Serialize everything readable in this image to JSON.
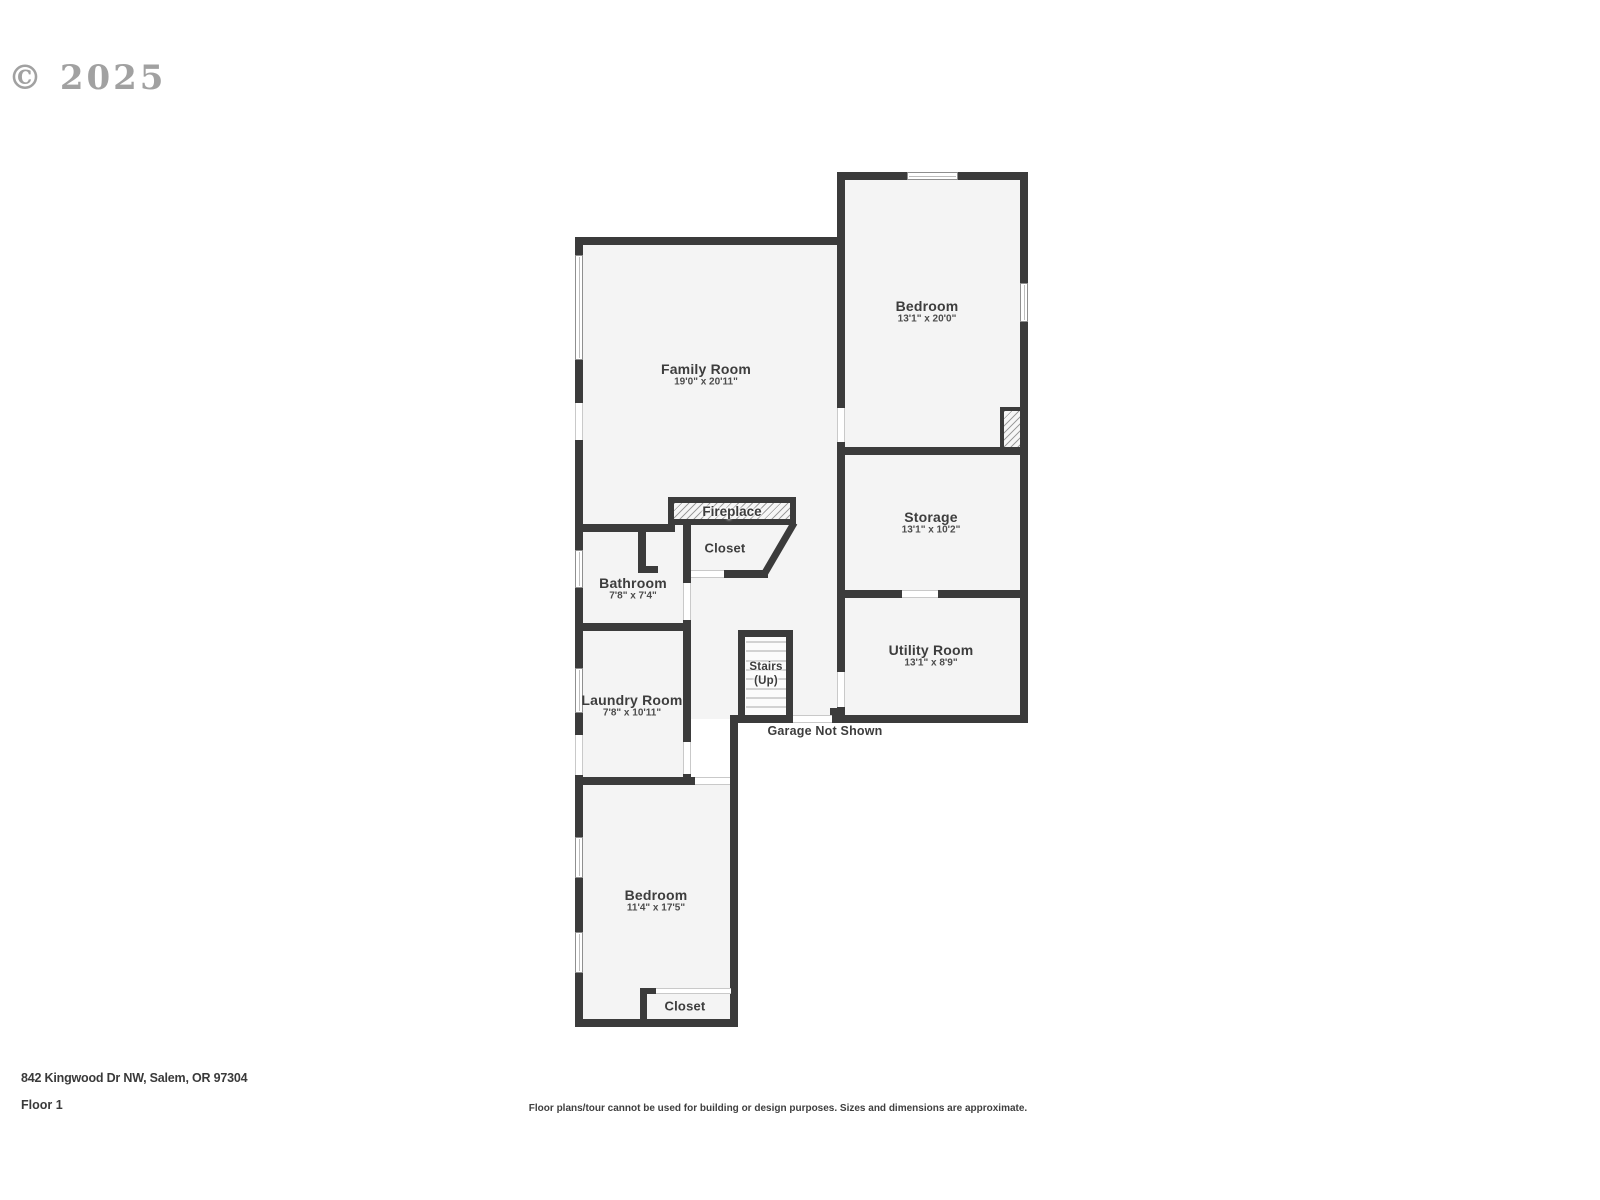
{
  "watermark": "© 2025",
  "colors": {
    "wall": "#3b3b3b",
    "room_fill": "#f4f4f4",
    "label": "#3d3d3d",
    "dim_text": "#4c4c4c",
    "window_line": "#8f8f8f",
    "opening_line": "#c9c9c9",
    "tread": "#d2d2d2"
  },
  "rooms": [
    {
      "name": "Family Room",
      "dims": "19'0\" x 20'11\""
    },
    {
      "name": "Bedroom",
      "dims": "13'1\" x 20'0\""
    },
    {
      "name": "Storage",
      "dims": "13'1\" x 10'2\""
    },
    {
      "name": "Utility Room",
      "dims": "13'1\" x 8'9\""
    },
    {
      "name": "Bathroom",
      "dims": "7'8\" x 7'4\""
    },
    {
      "name": "Laundry Room",
      "dims": "7'8\" x 10'11\""
    },
    {
      "name": "Bedroom",
      "dims": "11'4\" x 17'5\""
    }
  ],
  "features": {
    "fireplace": "Fireplace",
    "closet_upper": "Closet",
    "closet_lower": "Closet",
    "stairs_line1": "Stairs",
    "stairs_line2": "(Up)",
    "garage_note": "Garage Not Shown"
  },
  "footer": {
    "address": "842 Kingwood Dr NW, Salem, OR 97304",
    "floor_label": "Floor 1",
    "disclaimer": "Floor plans/tour cannot be used for building or design purposes. Sizes and dimensions are approximate."
  }
}
